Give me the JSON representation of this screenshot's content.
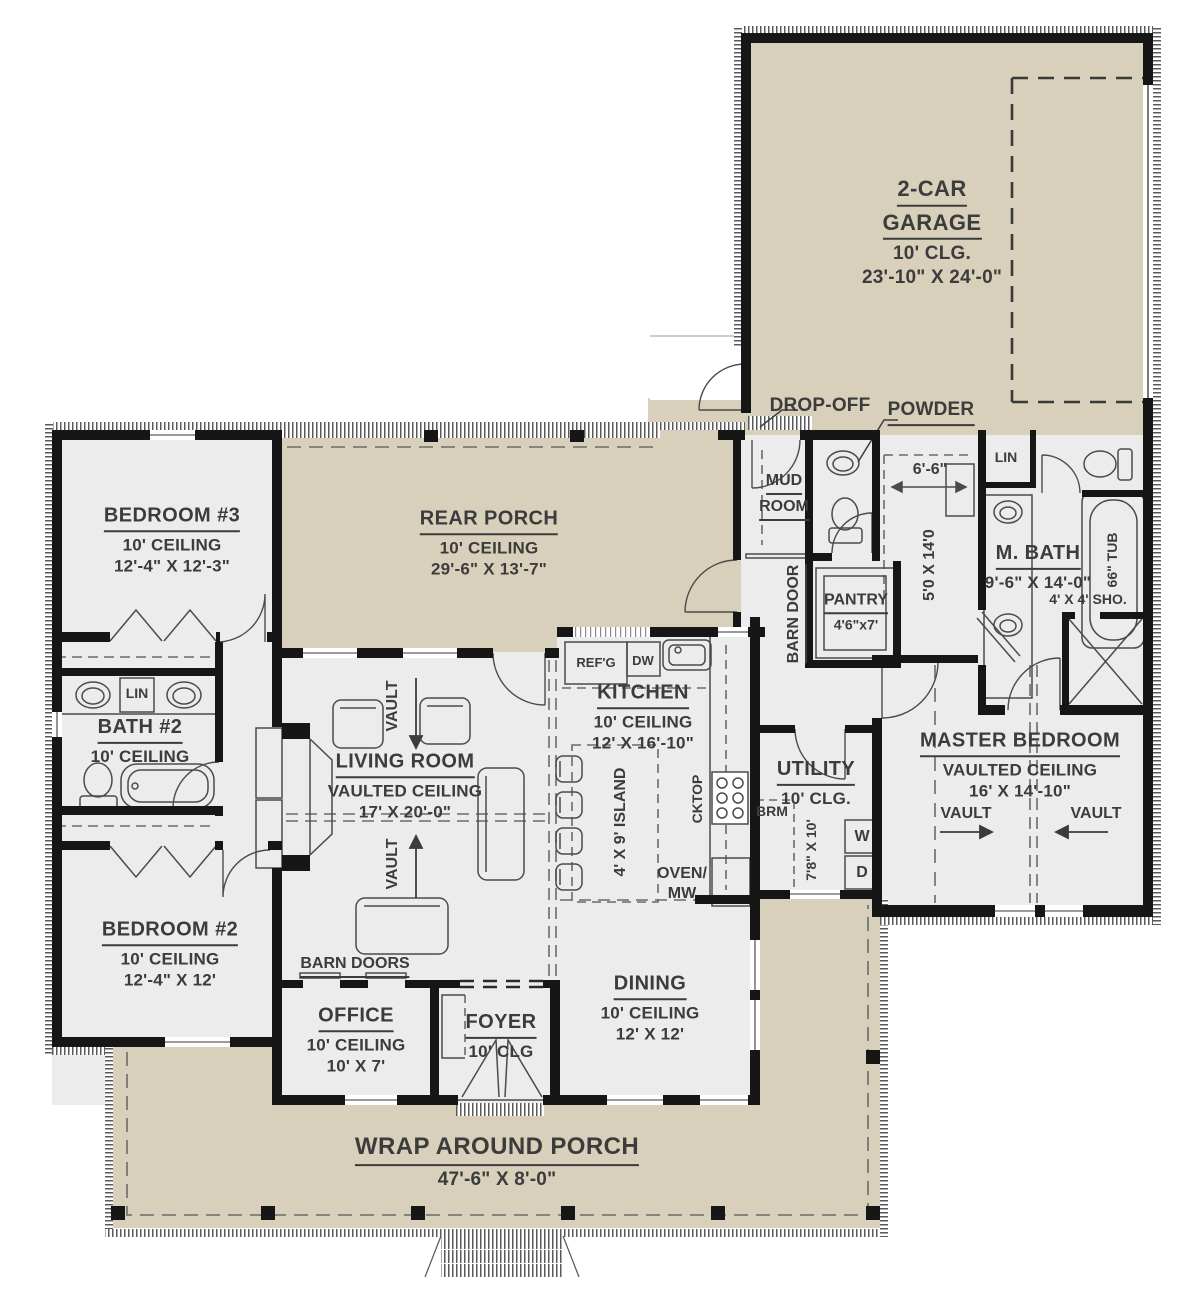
{
  "colors": {
    "porch_beige": "#d8d0bb",
    "interior_gray": "#ececec",
    "wall_black": "#161616",
    "text_gray": "#3c3c3c"
  },
  "rooms": {
    "garage": {
      "title1": "2-CAR",
      "title2": "GARAGE",
      "ceiling": "10' CLG.",
      "dims": "23'-10\" X 24'-0\""
    },
    "rear_porch": {
      "name": "REAR PORCH",
      "ceiling": "10' CEILING",
      "dims": "29'-6\" X 13'-7\""
    },
    "bedroom3": {
      "name": "BEDROOM #3",
      "ceiling": "10' CEILING",
      "dims": "12'-4\" X 12'-3\""
    },
    "bath2": {
      "name": "BATH #2",
      "ceiling": "10' CEILING"
    },
    "bedroom2": {
      "name": "BEDROOM #2",
      "ceiling": "10' CEILING",
      "dims": "12'-4\" X 12'"
    },
    "living": {
      "name": "LIVING ROOM",
      "ceiling": "VAULTED CEILING",
      "dims": "17' X 20'-0\""
    },
    "kitchen": {
      "name": "KITCHEN",
      "ceiling": "10' CEILING",
      "dims": "12' X 16'-10\""
    },
    "dining": {
      "name": "DINING",
      "ceiling": "10' CEILING",
      "dims": "12' X 12'"
    },
    "office": {
      "name": "OFFICE",
      "ceiling": "10' CEILING",
      "dims": "10' X 7'"
    },
    "foyer": {
      "name": "FOYER",
      "ceiling": "10' CLG"
    },
    "utility": {
      "name": "UTILITY",
      "ceiling": "10' CLG.",
      "dims": "7'8\" X 10'"
    },
    "master_bedroom": {
      "name": "MASTER BEDROOM",
      "ceiling": "VAULTED CEILING",
      "dims": "16' X 14'-10\""
    },
    "m_bath": {
      "name": "M. BATH",
      "dims": "9'-6\" X 14'-0\""
    },
    "mud_room": {
      "title1": "MUD",
      "title2": "ROOM"
    },
    "pantry": {
      "name": "PANTRY",
      "dims": "4'6\"x7'"
    },
    "powder": {
      "name": "POWDER"
    },
    "master_closet": {
      "width": "6'-6\"",
      "dims": "5'0 X 14'0"
    },
    "wrap_porch": {
      "name": "WRAP AROUND PORCH",
      "dims": "47'-6\" X 8'-0\""
    }
  },
  "labels": {
    "drop_off": "DROP-OFF",
    "barn_door": "BARN DOOR",
    "barn_doors": "BARN DOORS",
    "refg": "REF'G",
    "dw": "DW",
    "cktop": "CKTOP",
    "island": "4' X 9' ISLAND",
    "oven1": "OVEN/",
    "oven2": "MW",
    "brm": "BRM",
    "washer": "W",
    "dryer": "D",
    "lin": "LIN",
    "tub": "66\" TUB",
    "shower": "4' X 4' SHO.",
    "vault": "VAULT"
  }
}
